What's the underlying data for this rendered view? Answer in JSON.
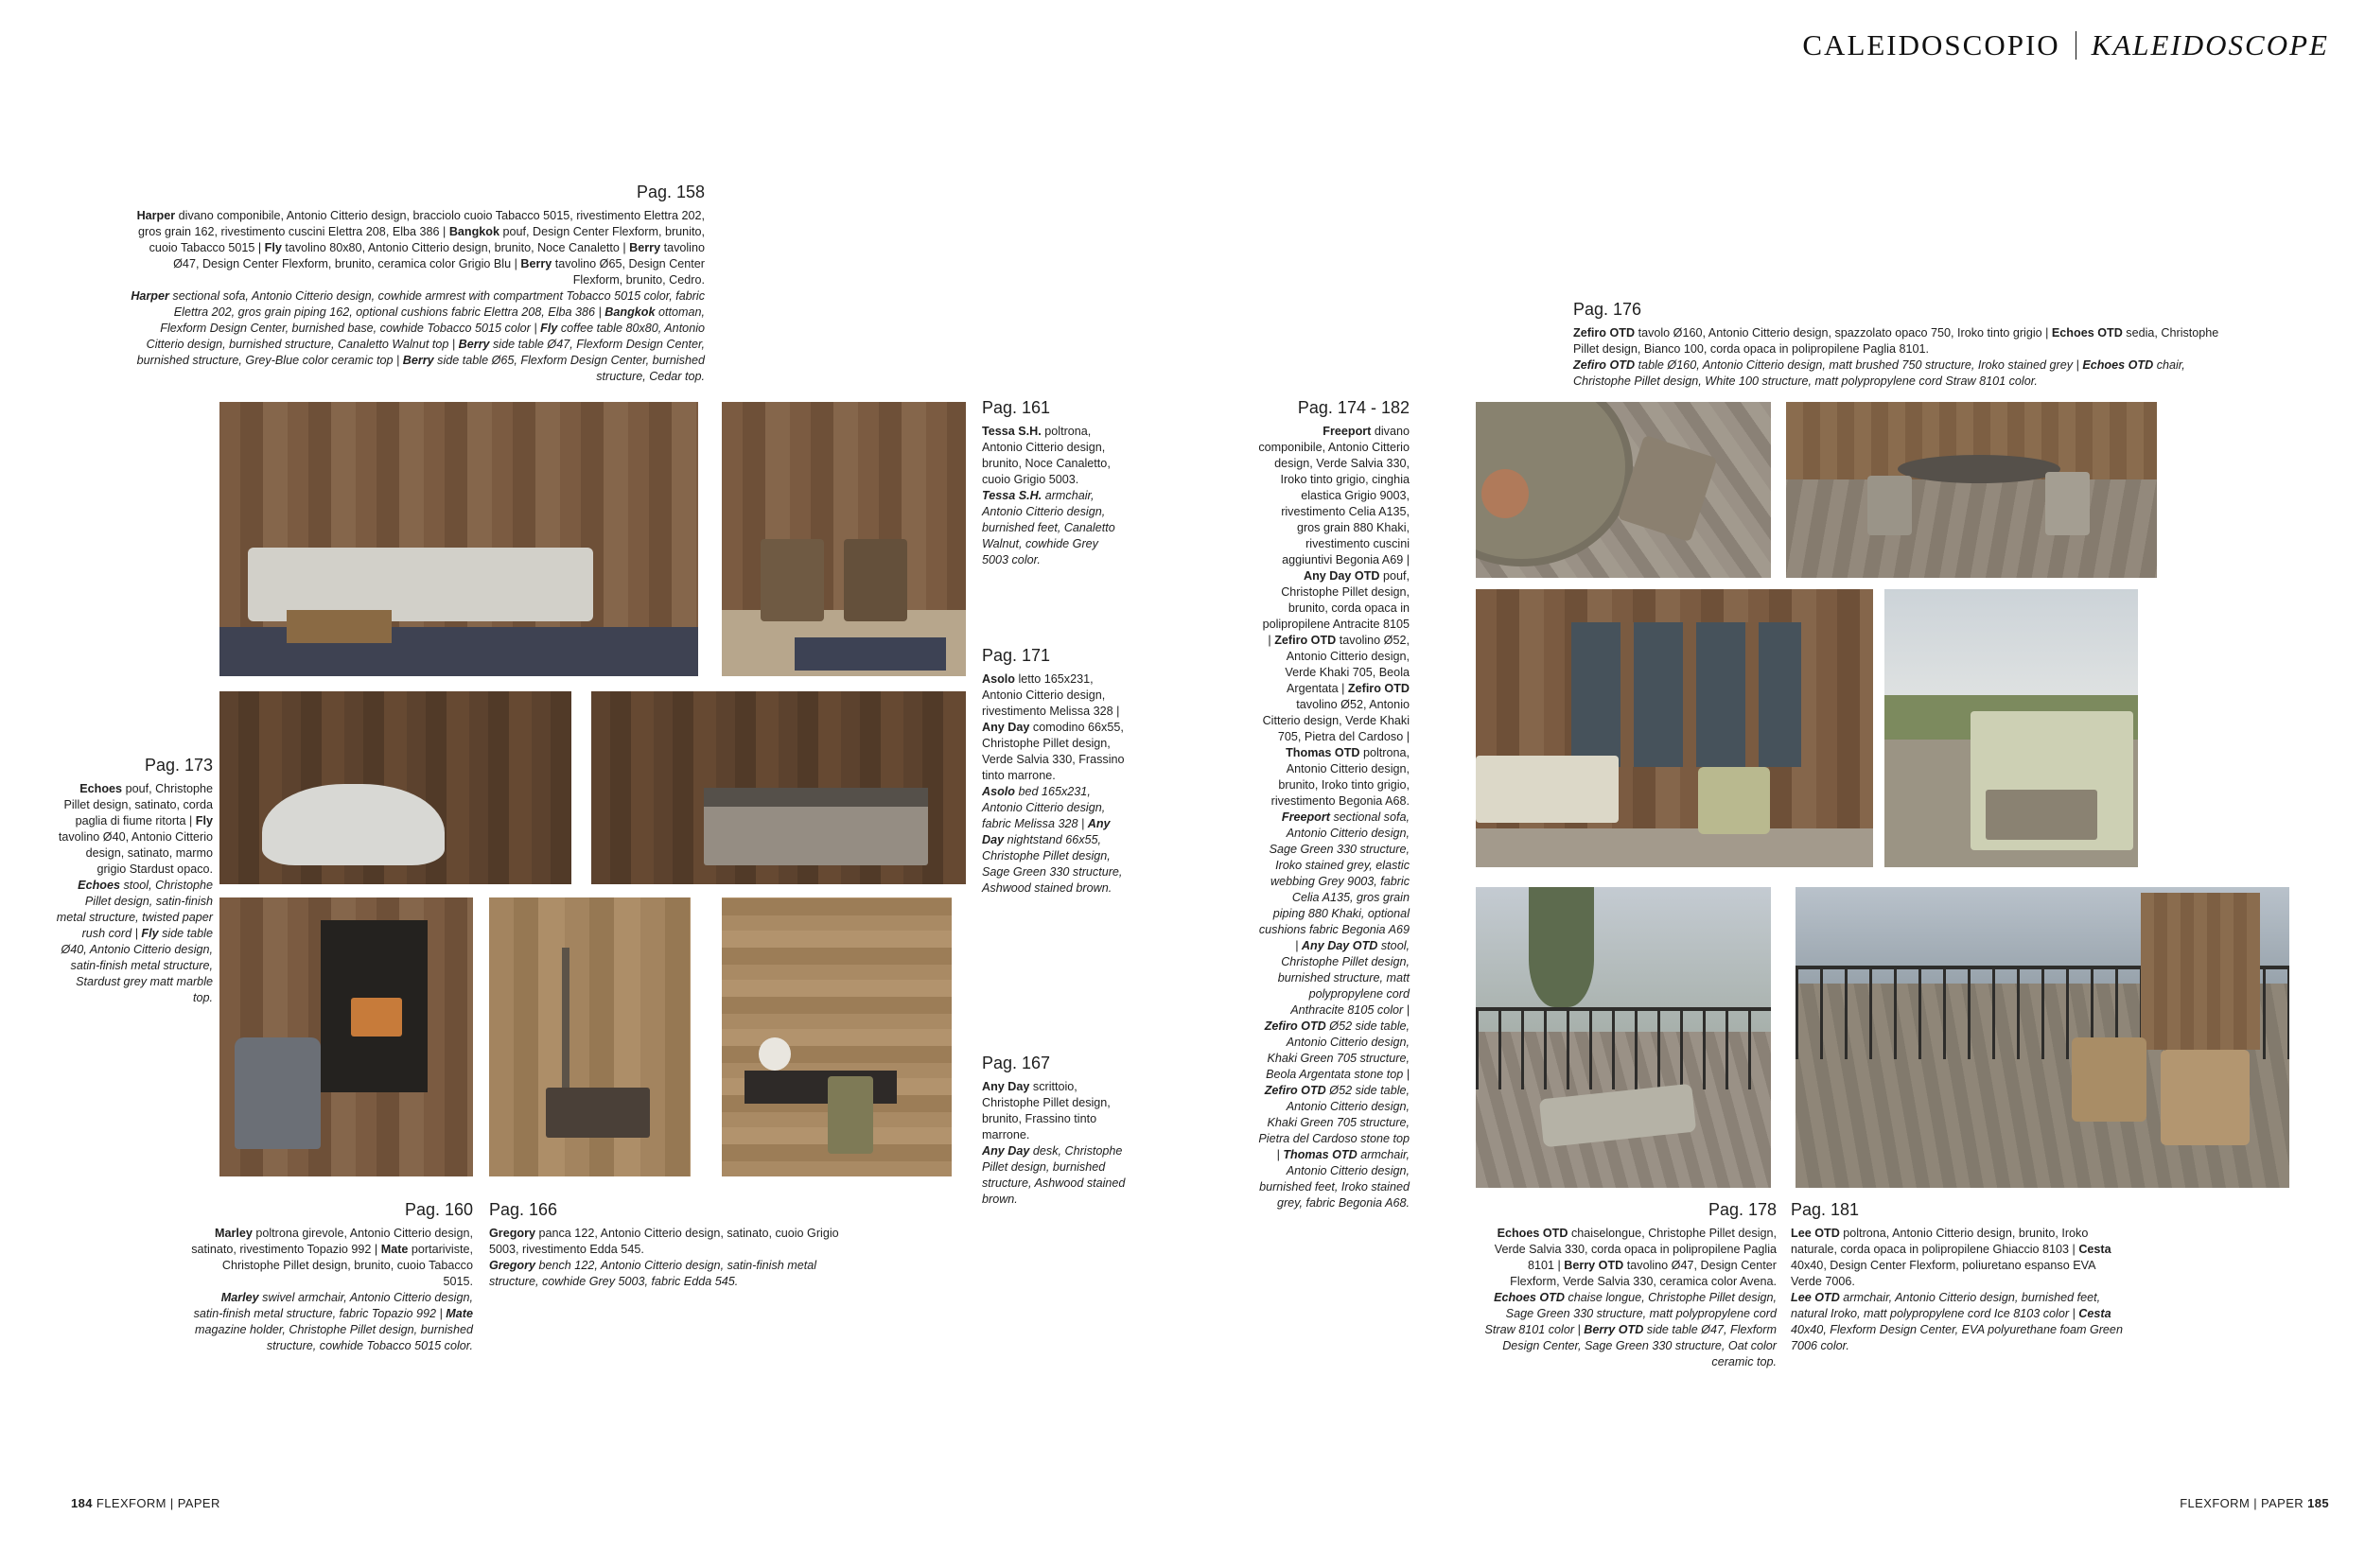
{
  "colors": {
    "paper": "#ffffff",
    "text": "#1e1e1e",
    "title": "#111111"
  },
  "header": {
    "title_it": "CALEIDOSCOPIO",
    "title_en": "KALEIDOSCOPE"
  },
  "footer": {
    "left_page_number": "184",
    "left_brand": "FLEXFORM | PAPER",
    "right_brand": "FLEXFORM | PAPER",
    "right_page_number": "185"
  },
  "blocks": {
    "p158": {
      "label": "Pag. 158",
      "runs": [
        {
          "t": "Harper",
          "s": "b"
        },
        {
          "t": " divano componibile, Antonio Citterio design, bracciolo cuoio Tabacco 5015, rivestimento Elettra 202, gros grain 162, rivestimento cuscini Elettra 208, Elba 386 | ",
          "s": ""
        },
        {
          "t": "Bangkok",
          "s": "b"
        },
        {
          "t": " pouf, Design Center Flexform, brunito, cuoio Tabacco 5015 | ",
          "s": ""
        },
        {
          "t": "Fly",
          "s": "b"
        },
        {
          "t": " tavolino 80x80, Antonio Citterio design, brunito, Noce Canaletto | ",
          "s": ""
        },
        {
          "t": "Berry",
          "s": "b"
        },
        {
          "t": " tavolino Ø47, Design Center Flexform, brunito, ceramica color Grigio Blu | ",
          "s": ""
        },
        {
          "t": "Berry",
          "s": "b"
        },
        {
          "t": " tavolino Ø65, Design Center Flexform, brunito, Cedro.",
          "s": ""
        },
        {
          "t": "Harper",
          "s": "bi",
          "nl": true
        },
        {
          "t": " sectional sofa, Antonio Citterio design, cowhide armrest with compartment Tobacco 5015 color, fabric Elettra 202, gros grain piping 162, optional cushions fabric Elettra 208, Elba 386 | ",
          "s": "i"
        },
        {
          "t": "Bangkok",
          "s": "bi"
        },
        {
          "t": " ottoman, Flexform Design Center, burnished base, cowhide Tobacco 5015 color | ",
          "s": "i"
        },
        {
          "t": "Fly",
          "s": "bi"
        },
        {
          "t": " coffee table 80x80, Antonio Citterio design, burnished structure, Canaletto Walnut top | ",
          "s": "i"
        },
        {
          "t": "Berry",
          "s": "bi"
        },
        {
          "t": " side table Ø47, Flexform Design Center, burnished structure, Grey-Blue color ceramic top | ",
          "s": "i"
        },
        {
          "t": "Berry",
          "s": "bi"
        },
        {
          "t": " side table Ø65, Flexform Design Center, burnished structure, Cedar top.",
          "s": "i"
        }
      ]
    },
    "p161": {
      "label": "Pag. 161",
      "runs": [
        {
          "t": "Tessa S.H.",
          "s": "b"
        },
        {
          "t": " poltrona, Antonio Citterio design, brunito, Noce Canaletto, cuoio Grigio 5003.",
          "s": ""
        },
        {
          "t": "Tessa S.H.",
          "s": "bi",
          "nl": true
        },
        {
          "t": " armchair, Antonio Citterio design, burnished feet, Canaletto Walnut, cowhide Grey 5003 color.",
          "s": "i"
        }
      ]
    },
    "p171": {
      "label": "Pag. 171",
      "runs": [
        {
          "t": "Asolo",
          "s": "b"
        },
        {
          "t": " letto 165x231, Antonio Citterio design, rivestimento Melissa 328 | ",
          "s": ""
        },
        {
          "t": "Any Day",
          "s": "b"
        },
        {
          "t": " comodino 66x55, Christophe Pillet design, Verde Salvia 330, Frassino tinto marrone.",
          "s": ""
        },
        {
          "t": "Asolo",
          "s": "bi",
          "nl": true
        },
        {
          "t": " bed 165x231, Antonio Citterio design, fabric Melissa 328 | ",
          "s": "i"
        },
        {
          "t": "Any Day",
          "s": "bi"
        },
        {
          "t": " nightstand 66x55, Christophe Pillet design, Sage Green 330 structure, Ashwood stained brown.",
          "s": "i"
        }
      ]
    },
    "p167": {
      "label": "Pag. 167",
      "runs": [
        {
          "t": "Any Day",
          "s": "b"
        },
        {
          "t": " scrittoio, Christophe Pillet design, brunito, Frassino tinto marrone.",
          "s": ""
        },
        {
          "t": "Any Day",
          "s": "bi",
          "nl": true
        },
        {
          "t": " desk, Christophe Pillet design, burnished structure, Ashwood stained brown.",
          "s": "i"
        }
      ]
    },
    "p173": {
      "label": "Pag. 173",
      "runs": [
        {
          "t": "Echoes",
          "s": "b"
        },
        {
          "t": " pouf, Christophe Pillet design, satinato, corda paglia di fiume ritorta | ",
          "s": ""
        },
        {
          "t": "Fly",
          "s": "b"
        },
        {
          "t": " tavolino Ø40, Antonio Citterio design, satinato, marmo grigio Stardust opaco.",
          "s": ""
        },
        {
          "t": "Echoes",
          "s": "bi",
          "nl": true
        },
        {
          "t": " stool, Christophe Pillet design, satin-finish metal structure, twisted paper rush cord | ",
          "s": "i"
        },
        {
          "t": "Fly",
          "s": "bi"
        },
        {
          "t": " side table Ø40, Antonio Citterio design, satin-finish metal structure, Stardust grey matt marble top.",
          "s": "i"
        }
      ]
    },
    "p160": {
      "label": "Pag. 160",
      "runs": [
        {
          "t": "Marley",
          "s": "b"
        },
        {
          "t": " poltrona girevole, Antonio Citterio design, satinato, rivestimento Topazio 992 | ",
          "s": ""
        },
        {
          "t": "Mate",
          "s": "b"
        },
        {
          "t": " portariviste, Christophe Pillet design, brunito, cuoio Tabacco 5015.",
          "s": ""
        },
        {
          "t": "Marley",
          "s": "bi",
          "nl": true
        },
        {
          "t": " swivel armchair, Antonio Citterio design, satin-finish metal structure, fabric Topazio 992 | ",
          "s": "i"
        },
        {
          "t": "Mate",
          "s": "bi"
        },
        {
          "t": " magazine holder, Christophe Pillet design, burnished structure, cowhide Tobacco 5015 color.",
          "s": "i"
        }
      ]
    },
    "p166": {
      "label": "Pag. 166",
      "runs": [
        {
          "t": "Gregory",
          "s": "b"
        },
        {
          "t": " panca 122, Antonio Citterio design, satinato, cuoio Grigio 5003, rivestimento Edda 545.",
          "s": ""
        },
        {
          "t": "Gregory",
          "s": "bi",
          "nl": true
        },
        {
          "t": " bench 122, Antonio Citterio design, satin-finish metal structure, cowhide Grey 5003, fabric Edda 545.",
          "s": "i"
        }
      ]
    },
    "p174_182": {
      "label": "Pag. 174 - 182",
      "runs": [
        {
          "t": "Freeport",
          "s": "b"
        },
        {
          "t": " divano componibile, Antonio Citterio design, Verde Salvia 330, Iroko tinto grigio, cinghia elastica Grigio 9003, rivestimento Celia A135, gros grain 880 Khaki, rivestimento cuscini aggiuntivi Begonia A69 | ",
          "s": ""
        },
        {
          "t": "Any Day OTD",
          "s": "b"
        },
        {
          "t": " pouf, Christophe Pillet design, brunito, corda opaca in polipropilene Antracite 8105 | ",
          "s": ""
        },
        {
          "t": "Zefiro OTD",
          "s": "b"
        },
        {
          "t": " tavolino Ø52, Antonio Citterio design, Verde Khaki 705, Beola Argentata | ",
          "s": ""
        },
        {
          "t": "Zefiro OTD",
          "s": "b"
        },
        {
          "t": " tavolino Ø52, Antonio Citterio design, Verde Khaki 705, Pietra del Cardoso | ",
          "s": ""
        },
        {
          "t": "Thomas OTD",
          "s": "b"
        },
        {
          "t": " poltrona, Antonio Citterio design, brunito, Iroko tinto grigio, rivestimento Begonia A68.",
          "s": ""
        },
        {
          "t": "Freeport",
          "s": "bi",
          "nl": true
        },
        {
          "t": " sectional sofa, Antonio Citterio design, Sage Green 330 structure, Iroko stained grey, elastic webbing Grey 9003, fabric Celia A135, gros grain piping 880 Khaki, optional cushions fabric Begonia A69 | ",
          "s": "i"
        },
        {
          "t": "Any Day OTD",
          "s": "bi"
        },
        {
          "t": " stool, Christophe Pillet design, burnished structure, matt polypropylene cord Anthracite 8105 color | ",
          "s": "i"
        },
        {
          "t": "Zefiro OTD",
          "s": "bi"
        },
        {
          "t": " Ø52 side table, Antonio Citterio design, Khaki Green 705 structure, Beola Argentata stone top | ",
          "s": "i"
        },
        {
          "t": "Zefiro OTD",
          "s": "bi"
        },
        {
          "t": " Ø52 side table, Antonio Citterio design, Khaki Green 705 structure, Pietra del Cardoso stone top | ",
          "s": "i"
        },
        {
          "t": "Thomas OTD",
          "s": "bi"
        },
        {
          "t": " armchair, Antonio Citterio design, burnished feet, Iroko stained grey, fabric Begonia A68.",
          "s": "i"
        }
      ]
    },
    "p176": {
      "label": "Pag. 176",
      "runs": [
        {
          "t": "Zefiro OTD",
          "s": "b"
        },
        {
          "t": " tavolo Ø160, Antonio Citterio design, spazzolato opaco 750, Iroko tinto grigio | ",
          "s": ""
        },
        {
          "t": "Echoes OTD",
          "s": "b"
        },
        {
          "t": " sedia, Christophe Pillet design, Bianco 100, corda opaca in polipropilene Paglia 8101.",
          "s": ""
        },
        {
          "t": "Zefiro OTD",
          "s": "bi",
          "nl": true
        },
        {
          "t": " table Ø160, Antonio Citterio design, matt brushed 750 structure, Iroko stained grey | ",
          "s": "i"
        },
        {
          "t": "Echoes OTD",
          "s": "bi"
        },
        {
          "t": " chair, Christophe Pillet design, White 100 structure, matt polypropylene cord Straw 8101 color.",
          "s": "i"
        }
      ]
    },
    "p178": {
      "label": "Pag. 178",
      "runs": [
        {
          "t": "Echoes OTD",
          "s": "b"
        },
        {
          "t": " chaiselongue, Christophe Pillet design, Verde Salvia 330, corda opaca in polipropilene Paglia 8101 | ",
          "s": ""
        },
        {
          "t": "Berry OTD",
          "s": "b"
        },
        {
          "t": " tavolino Ø47, Design Center Flexform, Verde Salvia 330, ceramica color Avena.",
          "s": ""
        },
        {
          "t": "Echoes OTD",
          "s": "bi",
          "nl": true
        },
        {
          "t": " chaise longue, Christophe Pillet design, Sage Green 330 structure, matt polypropylene cord Straw 8101 color | ",
          "s": "i"
        },
        {
          "t": "Berry OTD",
          "s": "bi"
        },
        {
          "t": " side table Ø47, Flexform Design Center, Sage Green 330 structure, Oat color ceramic top.",
          "s": "i"
        }
      ]
    },
    "p181": {
      "label": "Pag. 181",
      "runs": [
        {
          "t": "Lee OTD",
          "s": "b"
        },
        {
          "t": " poltrona, Antonio Citterio design, brunito, Iroko naturale, corda opaca in polipropilene Ghiaccio 8103 | ",
          "s": ""
        },
        {
          "t": "Cesta",
          "s": "b"
        },
        {
          "t": " 40x40, Design Center Flexform, poliuretano espanso EVA Verde 7006.",
          "s": ""
        },
        {
          "t": "Lee OTD",
          "s": "bi",
          "nl": true
        },
        {
          "t": " armchair, Antonio Citterio design, burnished feet, natural Iroko, matt polypropylene cord Ice 8103 color | ",
          "s": "i"
        },
        {
          "t": "Cesta",
          "s": "bi"
        },
        {
          "t": " 40x40, Flexform Design Center, EVA polyurethane foam Green 7006 color.",
          "s": "i"
        }
      ]
    }
  },
  "photos": [
    {
      "label": "Living room with Harper sectional sofa, Bangkok pouf and Berry side tables"
    },
    {
      "label": "Two Tessa S.H. armchairs by the window with floor lamp"
    },
    {
      "label": "Freestanding bathtub with Echoes stool and Fly side table"
    },
    {
      "label": "Asolo bed with Any Day nightstand"
    },
    {
      "label": "Marley swivel armchair and Mate magazine holder by the fireplace"
    },
    {
      "label": "Gregory bench with floor lamp by the window"
    },
    {
      "label": "Any Day desk with chair and table lamp"
    },
    {
      "label": "Top view of Zefiro OTD table and Echoes OTD chair on wooden deck"
    },
    {
      "label": "Zefiro OTD round table with Echoes OTD chairs on terrace"
    },
    {
      "label": "Terrace with Freeport sectional sofa, Zefiro OTD tables and Thomas OTD armchairs"
    },
    {
      "label": "Freeport outdoor sofa with open storage back on terrace"
    },
    {
      "label": "Echoes OTD chaise longue with Berry OTD side table on balcony"
    },
    {
      "label": "Lee OTD armchairs on balcony deck with mountain view"
    }
  ]
}
